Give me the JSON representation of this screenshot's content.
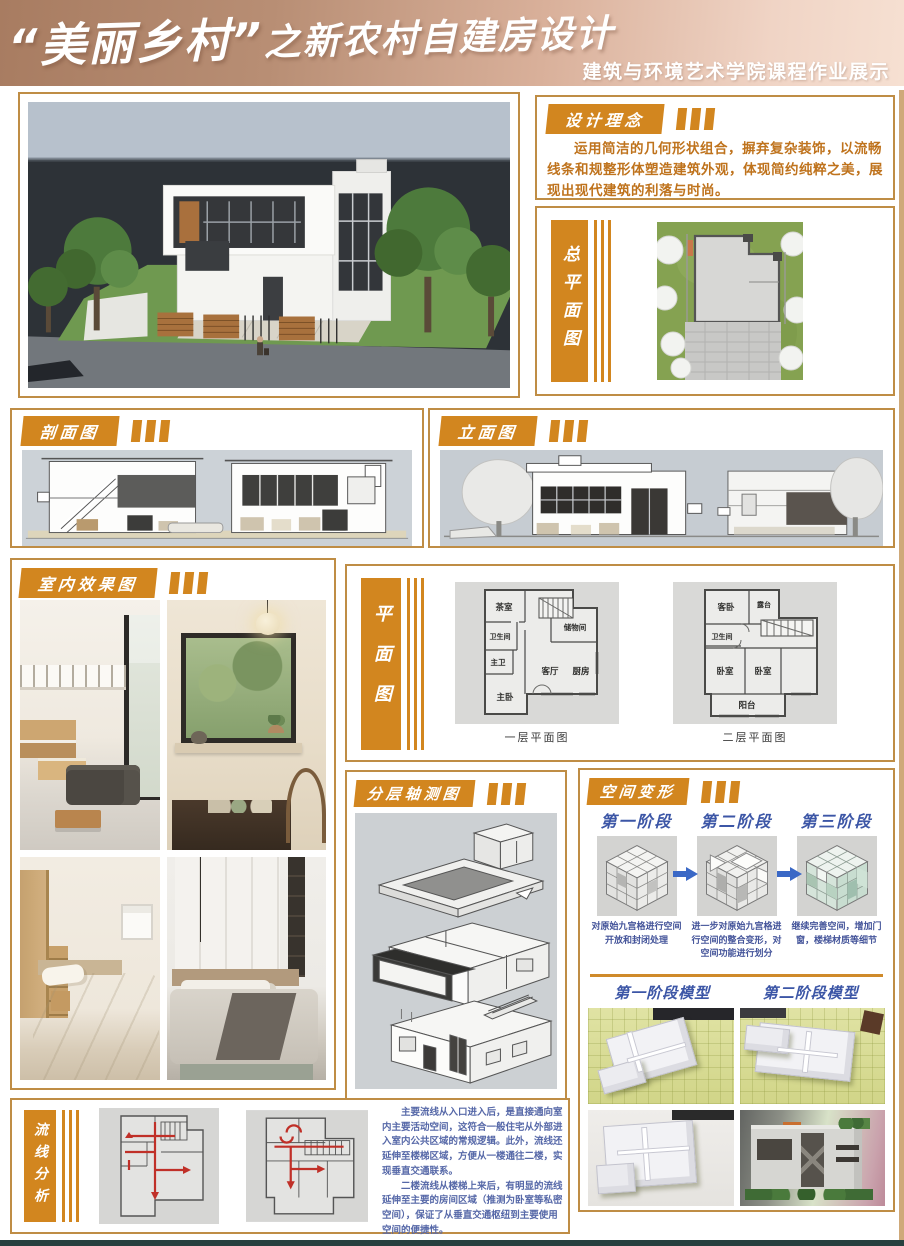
{
  "poster": {
    "title_quote": "“美丽乡村”",
    "title_rest": "之新农村自建房设计",
    "subtitle": "建筑与环境艺术学院课程作业展示"
  },
  "design_concept": {
    "label": "设计理念",
    "body": "运用简洁的几何形状组合，摒弃复杂装饰，以流畅线条和规整形体塑造建筑外观，体现简约纯粹之美，展现出现代建筑的利落与时尚。"
  },
  "site_plan": {
    "label": "总平面图"
  },
  "section_drawing": {
    "label": "剖面图"
  },
  "elevation": {
    "label": "立面图"
  },
  "interior": {
    "label": "室内效果图"
  },
  "floor_plan": {
    "label": "平面图",
    "plan1": {
      "caption": "一层平面图",
      "rooms": [
        "茶室",
        "卫生间",
        "主卫",
        "主卧",
        "储物间",
        "客厅",
        "厨房"
      ]
    },
    "plan2": {
      "caption": "二层平面图",
      "rooms": [
        "客卧",
        "露台",
        "卫生间",
        "卧室",
        "卧室",
        "阳台"
      ]
    }
  },
  "axonometric": {
    "label": "分层轴测图"
  },
  "space_transform": {
    "label": "空间变形",
    "stages": [
      {
        "title": "第一阶段",
        "caption": "对原始九宫格进行空间开放和封闭处理"
      },
      {
        "title": "第二阶段",
        "caption": "进一步对原始九宫格进行空间的整合变形，对空间功能进行划分"
      },
      {
        "title": "第三阶段",
        "caption": "继续完善空间，增加门窗，楼梯材质等细节"
      }
    ],
    "model_titles": [
      "第一阶段模型",
      "第二阶段模型"
    ]
  },
  "circulation": {
    "label": "流线分析",
    "body1": "主要流线从入口进入后，是直接通向室内主要活动空间，这符合一般住宅从外部进入室内公共区域的常规逻辑。此外，流线还延伸至楼梯区域，方便从一楼通往二楼，实现垂直交通联系。",
    "body2": "二楼流线从楼梯上来后，有明显的流线延伸至主要的房间区域（推测为卧室等私密空间），保证了从垂直交通枢纽到主要使用空间的便捷性。"
  },
  "colors": {
    "accent_orange": "#D2861F",
    "border_gold": "#BF8D45",
    "stage_blue": "#3C56A6",
    "footer_teal": "#27403F"
  }
}
